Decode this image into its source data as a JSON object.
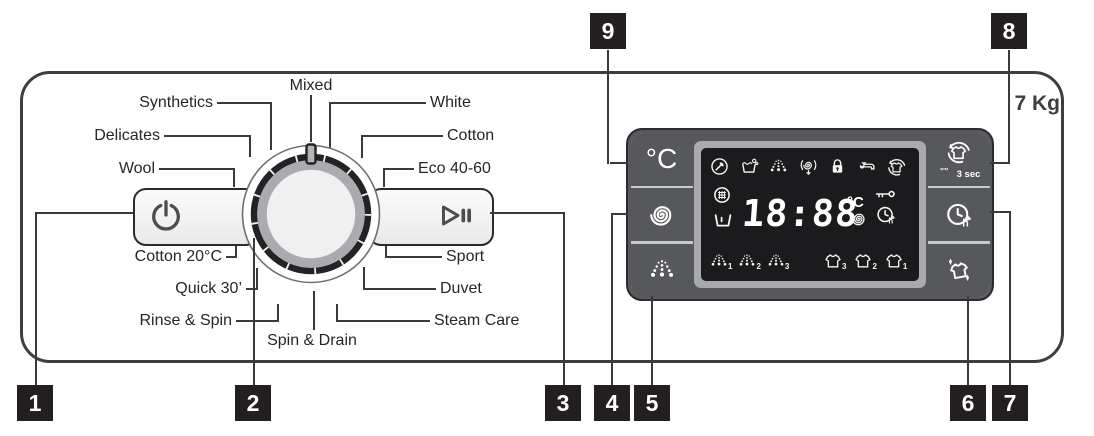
{
  "panel": {
    "capacity": "7 Kg"
  },
  "dial": {
    "pointer_position": "top",
    "top_program": "Mixed",
    "left_programs": [
      "Synthetics",
      "Delicates",
      "Wool",
      "Cotton 20°C",
      "Quick 30’",
      "Rinse & Spin"
    ],
    "right_programs": [
      "White",
      "Cotton",
      "Eco 40-60",
      "Sport",
      "Duvet",
      "Steam Care"
    ],
    "bottom_program": "Spin & Drain"
  },
  "buttons": {
    "power": {
      "icon": "power-icon"
    },
    "start_pause": {
      "icon": "play-pause-icon"
    },
    "temperature": {
      "label": "°C"
    },
    "spin": {
      "icon": "spin-spiral-icon"
    },
    "rinse": {
      "icon": "rinse-droplets-icon"
    },
    "drum_refresh": {
      "icon": "shirt-refresh-icon",
      "hold_icon": "key-icon",
      "hold_label": "3 sec"
    },
    "delay_end": {
      "icon": "delay-clock-h-icon"
    },
    "wrinkle_steam": {
      "icon": "shirt-sparkle-icon"
    }
  },
  "display": {
    "time": "18:88",
    "temp_unit": "°C",
    "status_icons_top": [
      "service-wrench-icon",
      "wash-tub-bubbles-icon",
      "rinse-droplets-icon",
      "spin-drain-icon",
      "child-lock-icon",
      "water-tap-icon",
      "shirt-refresh-icon"
    ],
    "status_icons_left": [
      "door-window-icon",
      "tub-icon"
    ],
    "status_icons_right": [
      "temp-unit-label",
      "spin-spiral-icon",
      "key-icon",
      "delay-clock-h-icon"
    ],
    "rinse_level_labels": [
      "1",
      "2",
      "3"
    ],
    "soil_level_labels": [
      "3",
      "2",
      "1"
    ]
  },
  "callouts": {
    "labels": [
      "1",
      "2",
      "3",
      "4",
      "5",
      "6",
      "7",
      "8",
      "9"
    ]
  },
  "colors": {
    "panel_border": "#3e3e40",
    "module_bg": "#57585b",
    "screen_bg": "#1b1b1d",
    "bezel": "#a8aaad",
    "callout_bg": "#231f20",
    "icon_white": "#ffffff"
  }
}
